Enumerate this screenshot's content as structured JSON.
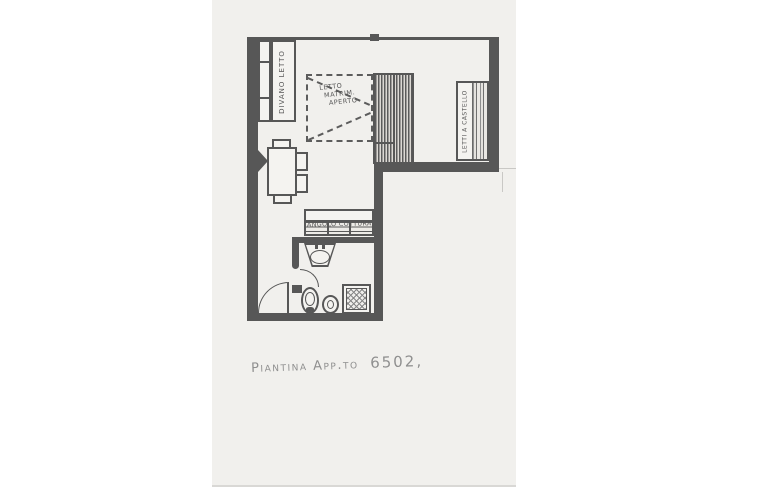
{
  "colors": {
    "bg": "#ffffff",
    "paper": "#f1f0ed",
    "ink": "#575757",
    "pencil": "#8f8f8f"
  },
  "floorplan": {
    "labels": {
      "sofa_bed": "DIVANO LETTO",
      "double_bed_line1": "LETTO",
      "double_bed_line2": "MATRIM.",
      "double_bed_line3": "APERTO",
      "bunk_beds": "LETTI A CASTELLO",
      "kitchenette": "ANGOLO COTTURA"
    },
    "caption": {
      "part1": "Piantina App.to",
      "part2": "6502",
      "flourish": ","
    }
  }
}
